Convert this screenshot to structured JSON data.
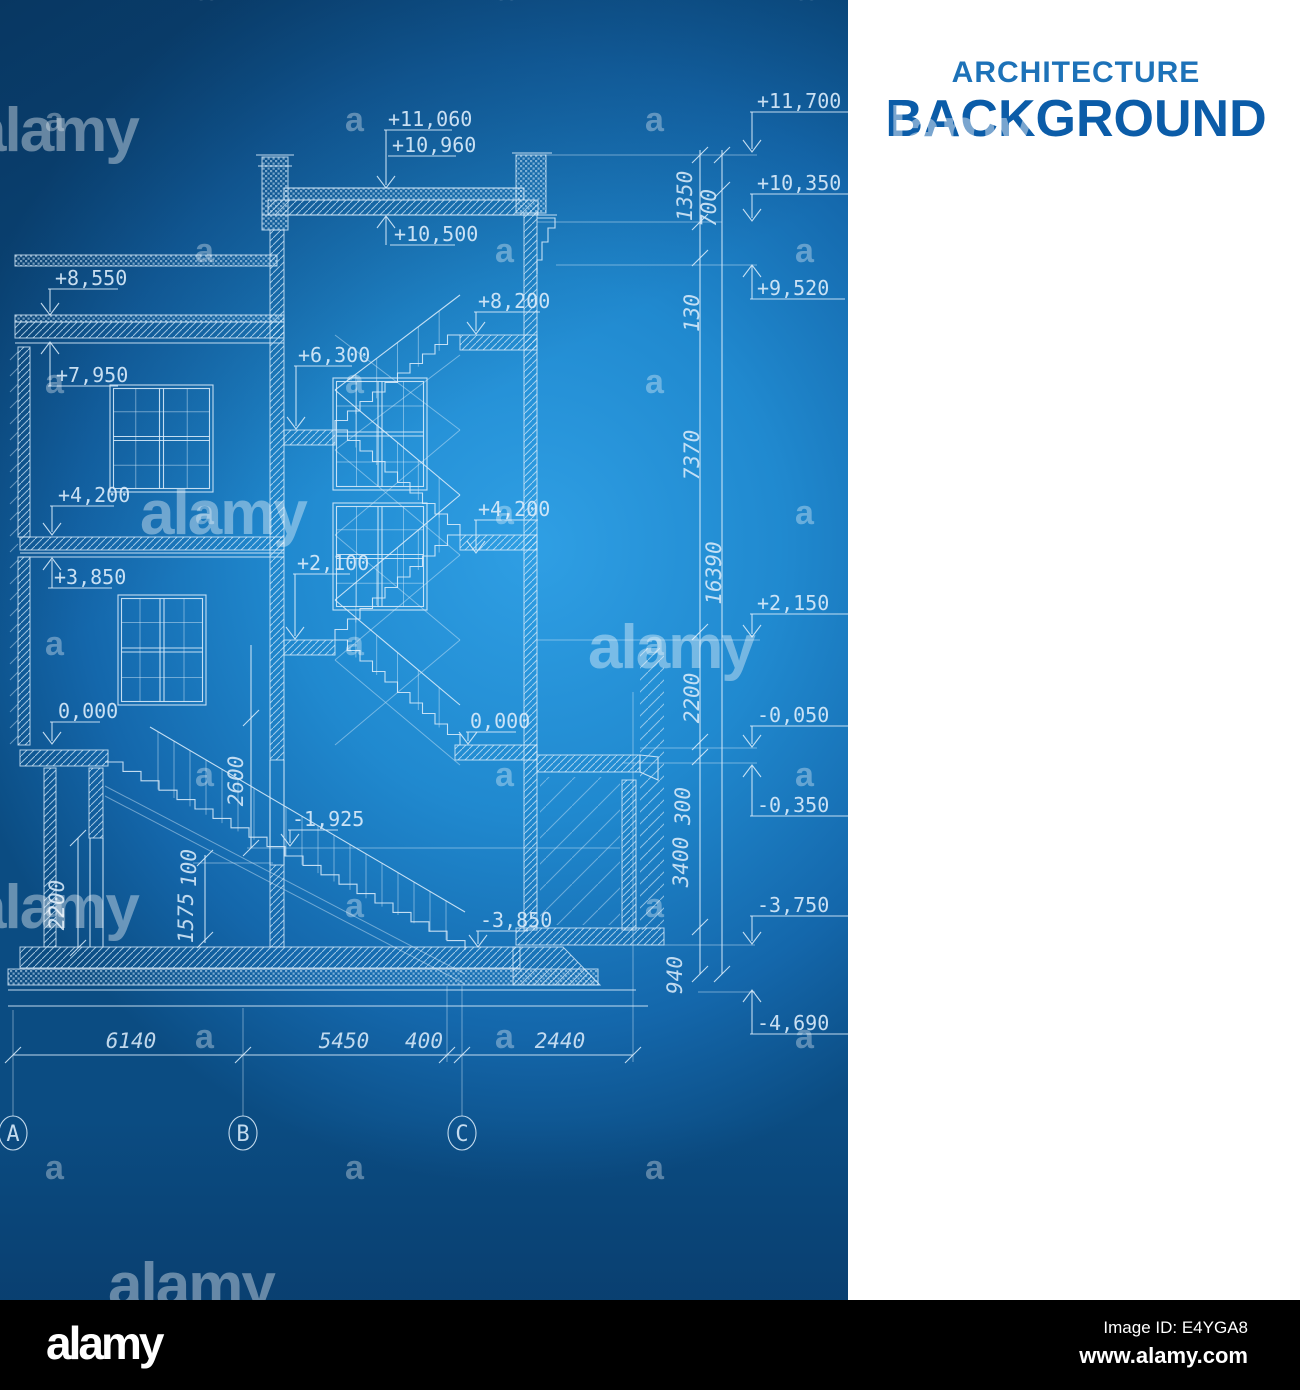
{
  "title": {
    "line1": "ARCHITECTURE",
    "line2": "BACKGROUND"
  },
  "watermark": {
    "small": "a",
    "large": "alamy"
  },
  "footer": {
    "logo": "alamy",
    "image_id": "Image ID: E4YGA8",
    "url": "www.alamy.com"
  },
  "blueprint": {
    "labels": {
      "e11060": "+11,060",
      "e10960": "+10,960",
      "e10500": "+10,500",
      "e8550": "+8,550",
      "e8200": "+8,200",
      "e7950": "+7,950",
      "e6300": "+6,300",
      "e4200l": "+4,200",
      "e4200r": "+4,200",
      "e3850": "+3,850",
      "e2100": "+2,100",
      "e0l": "0,000",
      "e0r": "0,000",
      "em1925": "-1,925",
      "em3850": "-3,850",
      "e11700": "+11,700",
      "e10350": "+10,350",
      "e9520": "+9,520",
      "e2150": "+2,150",
      "em0050": "-0,050",
      "em0350": "-0,350",
      "em3750": "-3,750",
      "em4690": "-4,690"
    },
    "dims": {
      "d1350": "1350",
      "d700": "700",
      "d130": "130",
      "d7370": "7370",
      "d16390": "16390",
      "d2200r": "2200",
      "d300": "300",
      "d3400": "3400",
      "d940": "940",
      "d2600": "2600",
      "d2200l": "2200",
      "d1575": "1575",
      "d100": "100",
      "d6140": "6140",
      "d5450": "5450",
      "d400": "400",
      "d2440": "2440"
    },
    "grid": {
      "a": "A",
      "b": "B",
      "c": "C"
    }
  }
}
